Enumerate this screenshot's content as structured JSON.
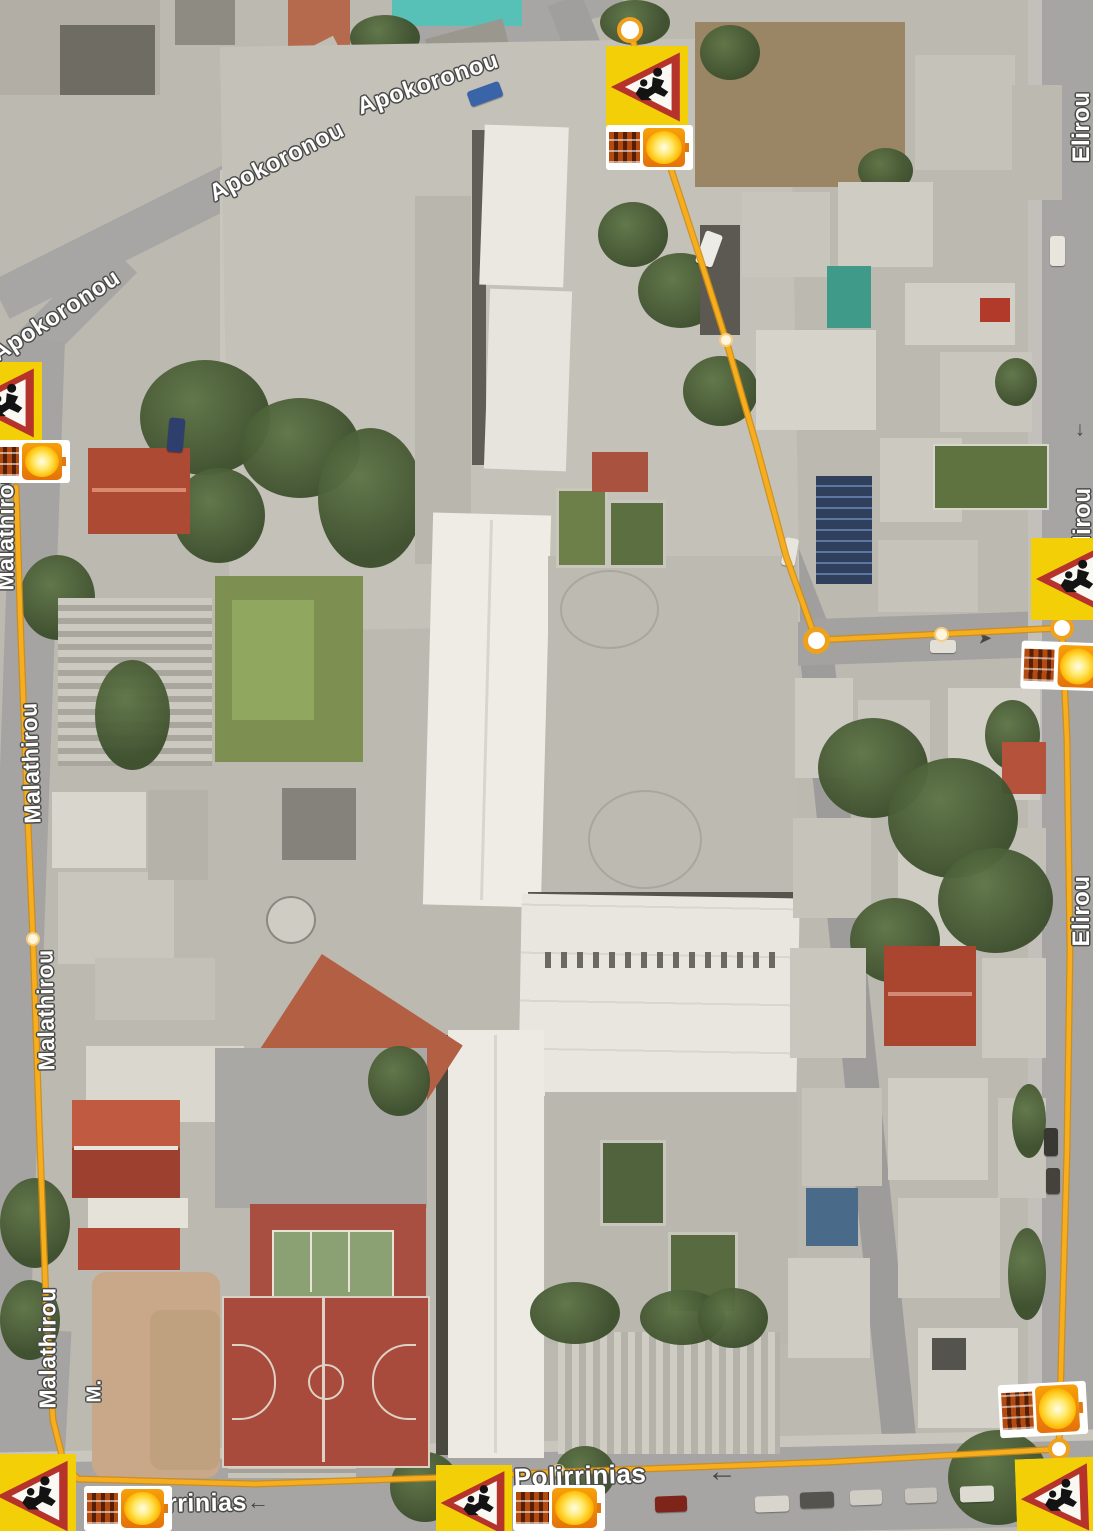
{
  "app": {
    "view_name": "satellite-map-with-school-route-overlay"
  },
  "labels": [
    {
      "id": "apokoronou-lower",
      "text": "Apokoronou"
    },
    {
      "id": "apokoronou-upper",
      "text": "Apokoronou"
    },
    {
      "id": "apokoronou-left-edge",
      "text": "Apokoronou"
    },
    {
      "id": "malathirou-1",
      "text": "Malathirou"
    },
    {
      "id": "malathirou-2",
      "text": "Malathirou"
    },
    {
      "id": "malathirou-3",
      "text": "Malathirou"
    },
    {
      "id": "malathirou-4",
      "text": "Malathirou"
    },
    {
      "id": "malathirou-partial",
      "text": "M."
    },
    {
      "id": "elirou-top",
      "text": "Elirou"
    },
    {
      "id": "elirou-mid",
      "text": "Elirou"
    },
    {
      "id": "elirou-lower",
      "text": "Elirou"
    },
    {
      "id": "polirrinias-left",
      "text": "Polirrinias"
    },
    {
      "id": "polirrinias-center",
      "text": "Polirrinias"
    }
  ],
  "arrows": {
    "left": "←",
    "down": "↓",
    "right": "➤"
  },
  "route": {
    "color": "#F2A41B",
    "node_fill": "#FFFFFF",
    "node_ring": "#EFA11C"
  },
  "markers": {
    "warning_sign": {
      "name": "children-crossing-warning-sign",
      "bg": "#F7D308",
      "border": "#B5332A",
      "pictogram": "children-running",
      "count_visible": 6
    },
    "beacon": {
      "name": "solar-powered-flashing-beacon",
      "glow": "#FFD400",
      "count_visible": 6
    }
  }
}
